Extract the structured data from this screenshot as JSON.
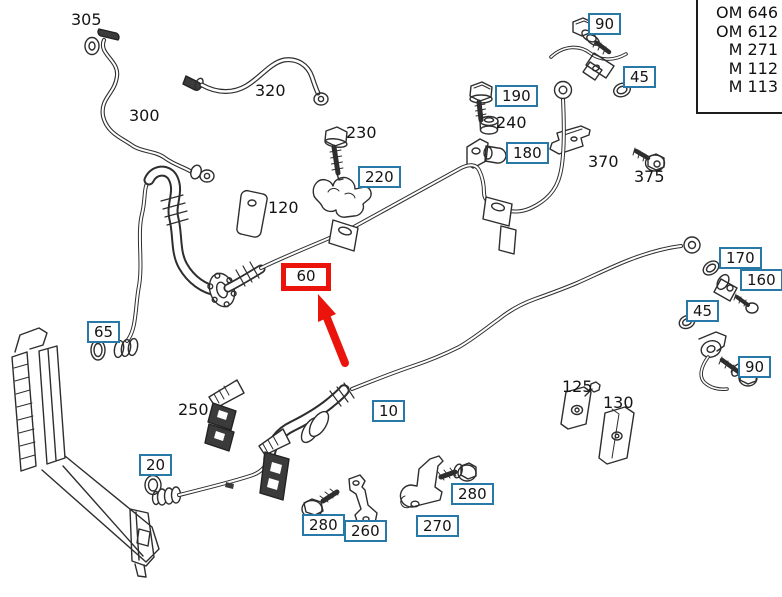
{
  "diagram_title": "AC refrigerant lines exploded parts diagram",
  "colors": {
    "line_color": "#2e2e2e",
    "label_box_border": "#2878a8",
    "highlight_red": "#ea140c"
  },
  "engine_box": {
    "lines": [
      "OM 646",
      "OM 612",
      "M 271",
      "M 112",
      "M 113"
    ]
  },
  "highlight": {
    "selected_part": "60",
    "marker": "red-box-and-arrow"
  },
  "labels": [
    {
      "text": "305",
      "type": "plain",
      "x": 71,
      "y": 10
    },
    {
      "text": "90",
      "type": "boxed",
      "x": 588,
      "y": 13
    },
    {
      "text": "45",
      "type": "boxed",
      "x": 623,
      "y": 66
    },
    {
      "text": "320",
      "type": "plain",
      "x": 255,
      "y": 81
    },
    {
      "text": "300",
      "type": "plain",
      "x": 129,
      "y": 106
    },
    {
      "text": "230",
      "type": "plain",
      "x": 346,
      "y": 123
    },
    {
      "text": "190",
      "type": "boxed",
      "x": 495,
      "y": 85
    },
    {
      "text": "240",
      "type": "plain",
      "x": 496,
      "y": 113
    },
    {
      "text": "180",
      "type": "boxed",
      "x": 506,
      "y": 142
    },
    {
      "text": "370",
      "type": "plain",
      "x": 588,
      "y": 152
    },
    {
      "text": "375",
      "type": "plain",
      "x": 634,
      "y": 167
    },
    {
      "text": "220",
      "type": "boxed",
      "x": 358,
      "y": 166
    },
    {
      "text": "120",
      "type": "plain",
      "x": 268,
      "y": 198
    },
    {
      "text": "60",
      "type": "highlight",
      "x": 281,
      "y": 263
    },
    {
      "text": "170",
      "type": "boxed",
      "x": 719,
      "y": 247
    },
    {
      "text": "160",
      "type": "boxed",
      "x": 740,
      "y": 269
    },
    {
      "text": "45",
      "type": "boxed",
      "x": 686,
      "y": 300
    },
    {
      "text": "90",
      "type": "boxed",
      "x": 738,
      "y": 356
    },
    {
      "text": "65",
      "type": "boxed",
      "x": 87,
      "y": 321
    },
    {
      "text": "250",
      "type": "plain",
      "x": 178,
      "y": 400
    },
    {
      "text": "10",
      "type": "boxed",
      "x": 372,
      "y": 400
    },
    {
      "text": "125",
      "type": "plain",
      "x": 562,
      "y": 377
    },
    {
      "text": "130",
      "type": "plain",
      "x": 603,
      "y": 393
    },
    {
      "text": "20",
      "type": "boxed",
      "x": 139,
      "y": 454
    },
    {
      "text": "280",
      "type": "boxed",
      "x": 302,
      "y": 514
    },
    {
      "text": "260",
      "type": "boxed",
      "x": 344,
      "y": 520
    },
    {
      "text": "270",
      "type": "boxed",
      "x": 416,
      "y": 515
    },
    {
      "text": "280",
      "type": "boxed",
      "x": 451,
      "y": 483
    }
  ]
}
